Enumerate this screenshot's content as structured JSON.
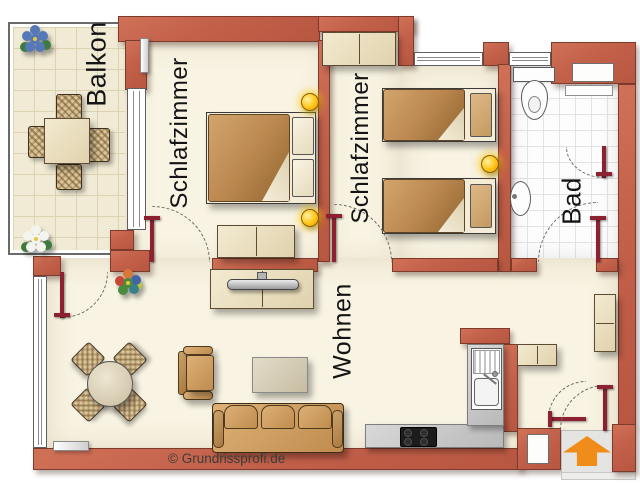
{
  "rooms": [
    {
      "id": "balkon",
      "label": "Balkon"
    },
    {
      "id": "schlafzimmer-1",
      "label": "Schlafzimmer"
    },
    {
      "id": "schlafzimmer-2",
      "label": "Schlafzimmer"
    },
    {
      "id": "bad",
      "label": "Bad"
    },
    {
      "id": "wohnen",
      "label": "Wohnen"
    }
  ],
  "footer": {
    "copyright": "© Grundrissprofi.de"
  },
  "entry": {
    "arrow_direction": "up"
  },
  "colors": {
    "wall": "#c2604a",
    "wall_outline": "#7c3b2b",
    "floor": "#f8f3e2",
    "bath_tile": "#fdfdfd",
    "balcony_tile": "#f1ebd5",
    "furniture_tan": "#c08c4e",
    "furniture_cream": "#eee3c8",
    "kitchen_counter": "#c9c9c9",
    "door_leaf": "#8c2130",
    "entry_arrow": "#f08c1a",
    "lamp": "#ffc515"
  }
}
